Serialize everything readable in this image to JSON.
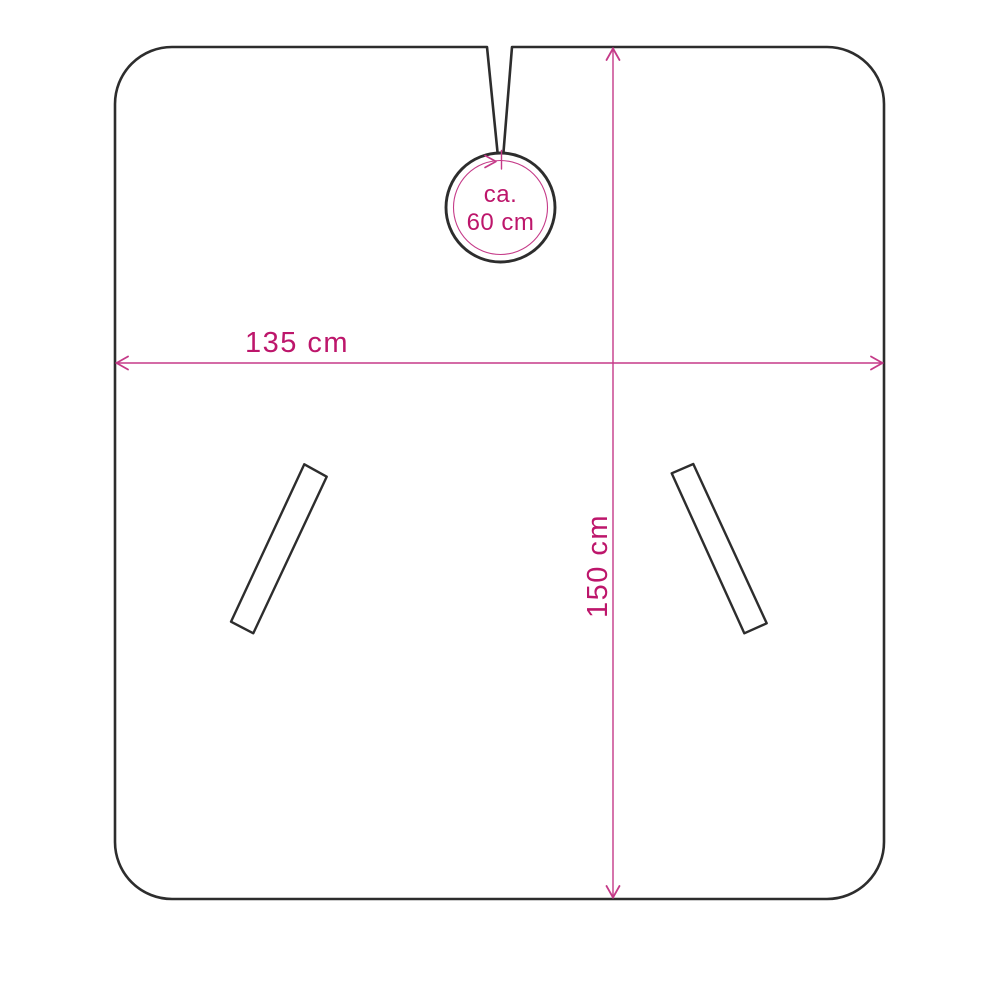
{
  "diagram": {
    "kind": "product-dimension-drawing",
    "labels": {
      "width": "135 cm",
      "height": "150 cm",
      "neck_approx": "ca.",
      "neck_value": "60 cm"
    },
    "measurements": {
      "width": "135 cm",
      "height": "150 cm",
      "neck_circumference": "ca. 60 cm"
    },
    "colors": {
      "outline": "#2d2d2d",
      "dimension_line": "#c53a88",
      "dimension_text": "#bd166b",
      "background": "#ffffff"
    }
  }
}
